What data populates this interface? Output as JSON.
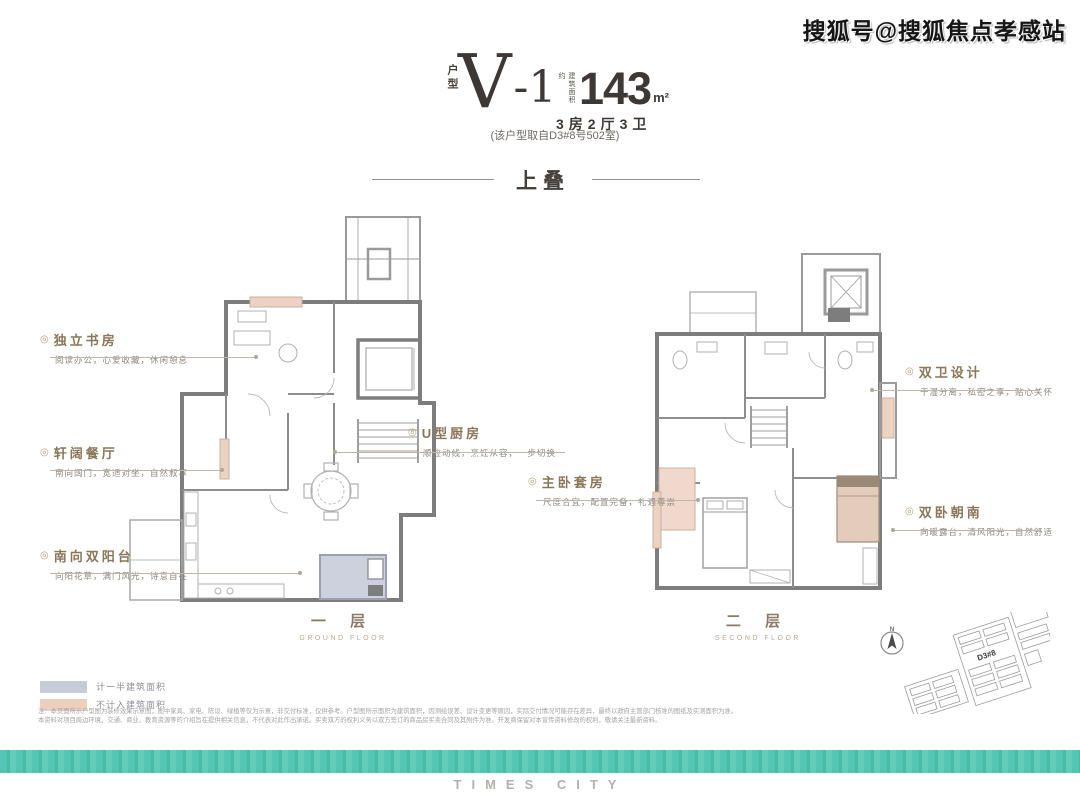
{
  "watermark": "搜狐号@搜狐焦点孝感站",
  "header": {
    "type_label": "户型",
    "type_name_v": "V",
    "type_name_rest": "-1",
    "area_prefix": "建筑面积约",
    "area_value": "143",
    "area_unit": "m²",
    "spec": "3房2厅3卫",
    "source_note": "(该户型取自D3#8号502室)",
    "section_title": "上叠"
  },
  "callouts": [
    {
      "marker": "◎",
      "title": "独立书房",
      "subtitle": "阅读办公，心爱收藏，休闲憩息"
    },
    {
      "marker": "◎",
      "title": "轩阔餐厅",
      "subtitle": "南向阔门，宽适对坐，自然叙享"
    },
    {
      "marker": "◎",
      "title": "南向双阳台",
      "subtitle": "向阳花草，满门风光，诗意自在"
    },
    {
      "marker": "◎",
      "title": "U型厨房",
      "subtitle": "顺应动线，烹饪从容，一步切换"
    },
    {
      "marker": "◎",
      "title": "双卫设计",
      "subtitle": "干湿分离，私密之享，贴心关怀"
    },
    {
      "marker": "◎",
      "title": "主卧套房",
      "subtitle": "尺度合宜，配置完备，礼遇尊崇"
    },
    {
      "marker": "◎",
      "title": "双卧朝南",
      "subtitle": "向暖露台，清风阳光，自然舒适"
    }
  ],
  "floors": [
    {
      "label": "一 层",
      "sublabel": "GROUND FLOOR"
    },
    {
      "label": "二 层",
      "sublabel": "SECOND FLOOR"
    }
  ],
  "legend": [
    {
      "label": "计一半建筑面积",
      "color": "#c6cbd8"
    },
    {
      "label": "不计入建筑面积",
      "color": "#ecd0bd"
    }
  ],
  "site_plan": {
    "compass_letter": "N",
    "highlight_label": "D3#8"
  },
  "disclaimer": {
    "line1": "注：本页面所示户型图为装修效果示意图，图中家具、家电、陈设、绿植等仅为示意，非交付标准，仅供参考。户型图所示面积为建筑面积，因测绘误差、设计变更等原因，实际交付情况可能存在差异，最终以政府主管部门核准的图纸及实测面积为准。",
    "line2": "本资料对项目周边环境、交通、商业、教育资源等的介绍旨在提供相关信息，不代表对此作出承诺。买卖双方的权利义务以双方签订的商品房买卖合同及其附件为准。开发商保留对本宣传资料修改的权利，敬请关注最新资料。"
  },
  "footer": {
    "brand": "TIMES CITY"
  },
  "colors": {
    "accent_teal": "#54c5b3",
    "title_charcoal": "#3d3835",
    "callout_gold": "#8a7658",
    "legend_half_area": "#c6cbd8",
    "legend_no_area": "#ecd0bd",
    "plan_wall": "#7d7d7d",
    "plan_pink": "#ecd2c3"
  }
}
